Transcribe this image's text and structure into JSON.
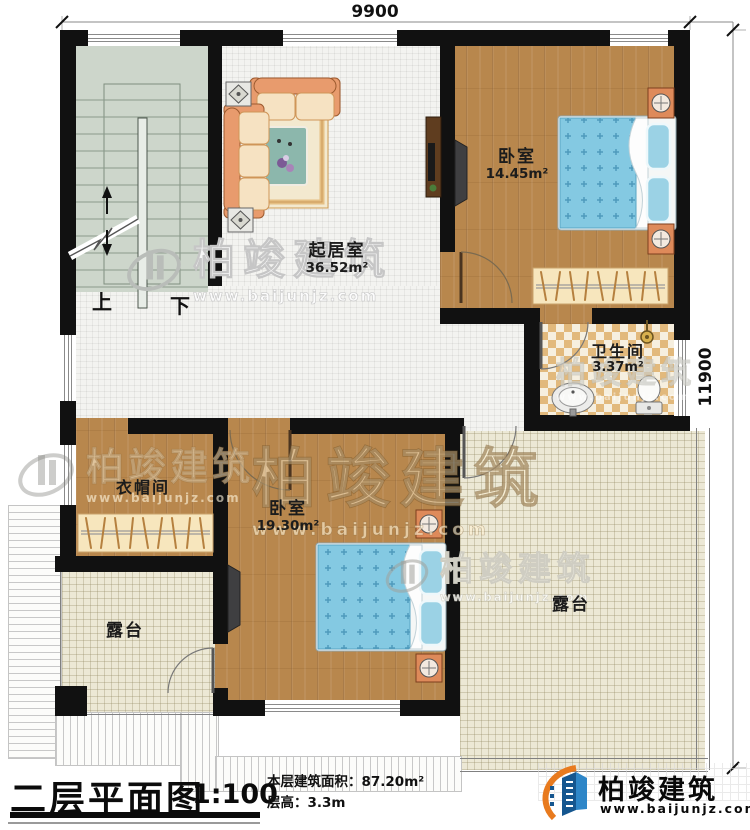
{
  "dimensions": {
    "top_width": "9900",
    "right_height": "11900"
  },
  "rooms": {
    "living": {
      "label": "起居室",
      "area": "36.52m²"
    },
    "bedroom1": {
      "label": "卧室",
      "area": "14.45m²"
    },
    "bedroom2": {
      "label": "卧室",
      "area": "19.30m²"
    },
    "bathroom": {
      "label": "卫生间",
      "area": "3.37m²"
    },
    "cloakroom": {
      "label": "衣帽间"
    },
    "terrace_left": {
      "label": "露台"
    },
    "terrace_right": {
      "label": "露台"
    }
  },
  "stairs": {
    "up_label": "上",
    "down_label": "下"
  },
  "watermark": {
    "brand": "柏竣建筑",
    "url": "www.baijunjz.com"
  },
  "title_block": {
    "title": "二层平面图",
    "scale": "1:100",
    "floor_area": "本层建筑面积：87.20m²",
    "floor_height": "层高：3.3m"
  },
  "logo": {
    "brand": "柏竣建筑",
    "url": "www.baijunjz.com"
  },
  "colors": {
    "wall": "#111111",
    "wood_floor": "#b8874d",
    "tile_floor": "#f3f3f0",
    "terrace_floor": "#ece8d5",
    "stair_floor": "#cdd6cb",
    "bath_tile": "#e2b97c",
    "bed": "#84c9e2",
    "sofa": "#e89b6d",
    "brand_blue": "#15568f",
    "brand_orange": "#e87a1e"
  }
}
